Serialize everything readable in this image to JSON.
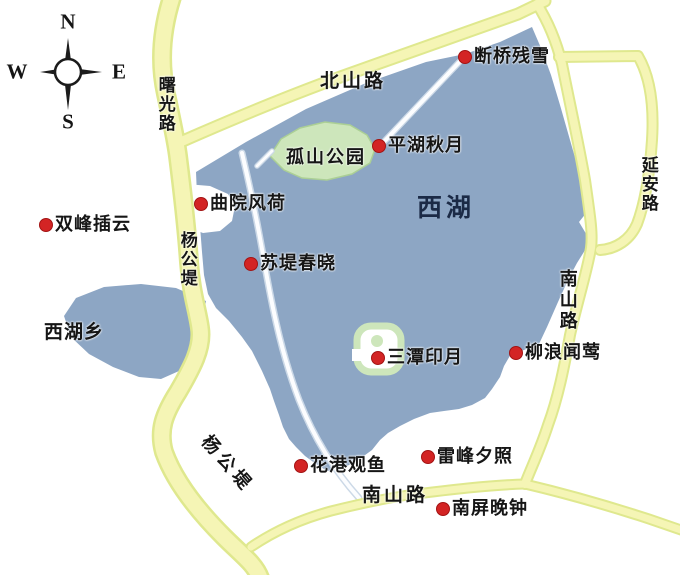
{
  "colors": {
    "lake": "#8da6c4",
    "park": "#cde6bb",
    "park_edge": "#abcf95",
    "road_fill": "#f5f5b5",
    "road_edge": "#dfe88e",
    "causeway": "#fcfdff",
    "causeway_edge": "#ccd9e7",
    "marker": "#d32424",
    "marker_edge": "#a31313",
    "label": "#161616",
    "lake_label": "#1b2a46",
    "compass": "#1c1c1c"
  },
  "compass": {
    "north": "N",
    "south": "S",
    "east": "E",
    "west": "W"
  },
  "lake": {
    "name": "西湖"
  },
  "island_park": {
    "name": "孤山公园"
  },
  "district": {
    "name": "西湖乡"
  },
  "roads": {
    "shuguang": "曙光路",
    "beishan": "北山路",
    "yanggong_upper": "杨公堤",
    "yanggong_lower": "杨公堤",
    "yanan": "延安路",
    "nanshan_east": "南山路",
    "nanshan_south": "南山路"
  },
  "spots": [
    {
      "id": "duanqiao-canxue",
      "name": "断桥残雪",
      "x": 465,
      "y": 57
    },
    {
      "id": "pinghu-qiuyue",
      "name": "平湖秋月",
      "x": 379,
      "y": 146
    },
    {
      "id": "quyuan-fenghe",
      "name": "曲院风荷",
      "x": 201,
      "y": 204
    },
    {
      "id": "shuangfeng-chayun",
      "name": "双峰插云",
      "x": 46,
      "y": 225
    },
    {
      "id": "sudi-chunxiao",
      "name": "苏堤春晓",
      "x": 251,
      "y": 264
    },
    {
      "id": "santan-yinyue",
      "name": "三潭印月",
      "x": 378,
      "y": 358
    },
    {
      "id": "liulang-wenying",
      "name": "柳浪闻莺",
      "x": 516,
      "y": 353
    },
    {
      "id": "huagang-guanyu",
      "name": "花港观鱼",
      "x": 301,
      "y": 466
    },
    {
      "id": "leifeng-xizhao",
      "name": "雷峰夕照",
      "x": 428,
      "y": 457
    },
    {
      "id": "nanping-wanzhong",
      "name": "南屏晚钟",
      "x": 443,
      "y": 509
    }
  ]
}
